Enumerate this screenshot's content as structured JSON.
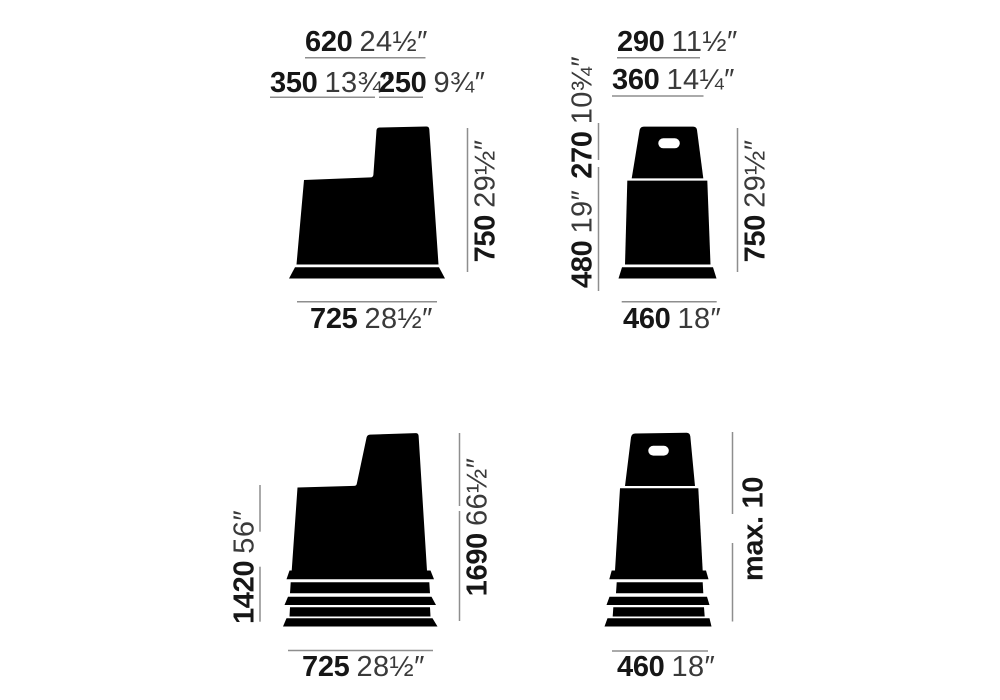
{
  "colors": {
    "background": "#ffffff",
    "shape": "#000000",
    "dim_line": "#8e8e8e",
    "metric_text": "#161616",
    "imperial_text": "#3a3a3a"
  },
  "figures": {
    "stool_side": {
      "title": "stool single side view",
      "width_top": {
        "metric": "620",
        "imperial": "24½″"
      },
      "width_step": {
        "metric": "350",
        "imperial": "13¾″"
      },
      "width_back": {
        "metric": "250",
        "imperial": "9¾″"
      },
      "height_total": {
        "metric": "750",
        "imperial": "29½″"
      },
      "width_base": {
        "metric": "725",
        "imperial": "28½″"
      }
    },
    "stool_front": {
      "title": "stool single front view",
      "width_top": {
        "metric": "290",
        "imperial": "11½″"
      },
      "width_shoulder": {
        "metric": "360",
        "imperial": "14¼″"
      },
      "height_lower": {
        "metric": "480",
        "imperial": "19″"
      },
      "height_upper": {
        "metric": "270",
        "imperial": "10¾″"
      },
      "height_total": {
        "metric": "750",
        "imperial": "29½″"
      },
      "width_base": {
        "metric": "460",
        "imperial": "18″"
      }
    },
    "stack_side": {
      "title": "stacked stools side view",
      "height_lower": {
        "metric": "1420",
        "imperial": "56″"
      },
      "height_total": {
        "metric": "1690",
        "imperial": "66½″"
      },
      "width_base": {
        "metric": "725",
        "imperial": "28½″"
      }
    },
    "stack_front": {
      "title": "stacked stools front view",
      "stack_note": "max. 10",
      "width_base": {
        "metric": "460",
        "imperial": "18″"
      }
    }
  }
}
